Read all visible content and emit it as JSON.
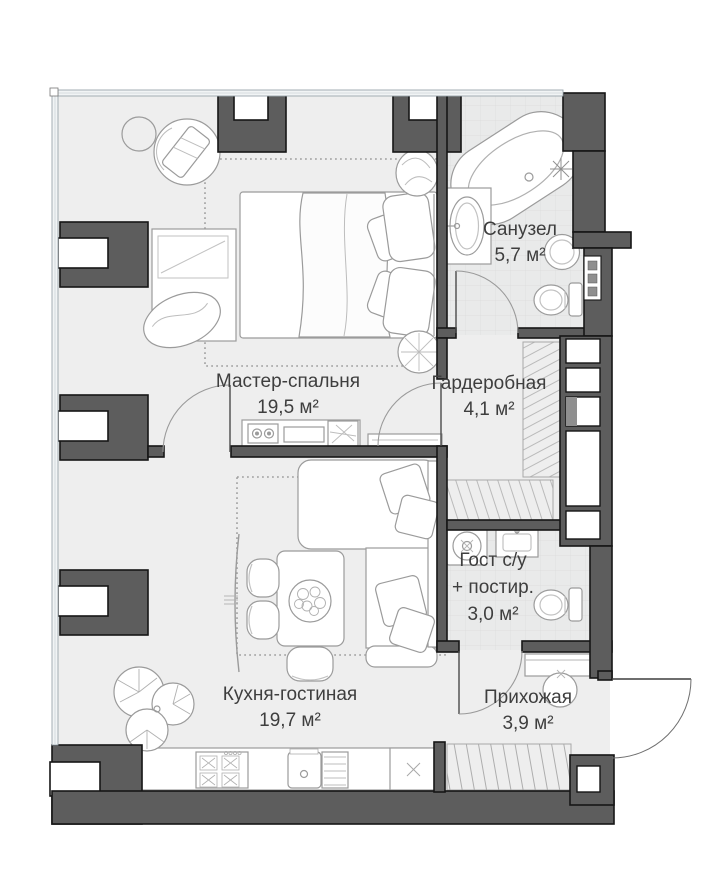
{
  "plan_type": "apartment-floor-plan",
  "rooms": {
    "master": {
      "name": "Мастер-спальня",
      "area": "19,5 м²"
    },
    "bathroom": {
      "name": "Санузел",
      "area": "5,7 м²"
    },
    "wardrobe": {
      "name": "Гардеробная",
      "area": "4,1 м²"
    },
    "guest_wc": {
      "name": "Гост с/у",
      "name2": "+ постир.",
      "area": "3,0 м²"
    },
    "kitchen": {
      "name": "Кухня-гостиная",
      "area": "19,7 м²"
    },
    "hallway": {
      "name": "Прихожая",
      "area": "3,9 м²"
    }
  },
  "furniture_icons": [
    "bed",
    "pillows",
    "duvet",
    "foot-bench",
    "armchair",
    "side-table",
    "nightstand-plant",
    "dresser-console",
    "radiator-shelf",
    "bathtub",
    "vanity-sink",
    "round-basin",
    "toilet",
    "washing-machine",
    "laundry-sink",
    "wardrobe-shelving",
    "closet-hangers",
    "sofa",
    "dining-table",
    "dining-chair",
    "fruit-bowl",
    "tv-screen",
    "kitchen-counter",
    "stove",
    "kitchen-sink",
    "drainboard",
    "dishwasher",
    "monstera-plant",
    "hallway-console",
    "pouf",
    "entrance-door",
    "interior-door",
    "window",
    "wall-column",
    "ventilation-shaft",
    "electric-panel"
  ],
  "colors": {
    "wall": "#5d5d5d",
    "wall_outline": "#161616",
    "floor": "#eeeeee",
    "tile_floor": "#e9eaea",
    "furniture_line": "#9b9b9b",
    "window": "#f1f4f5",
    "text": "#3e3e3e"
  }
}
